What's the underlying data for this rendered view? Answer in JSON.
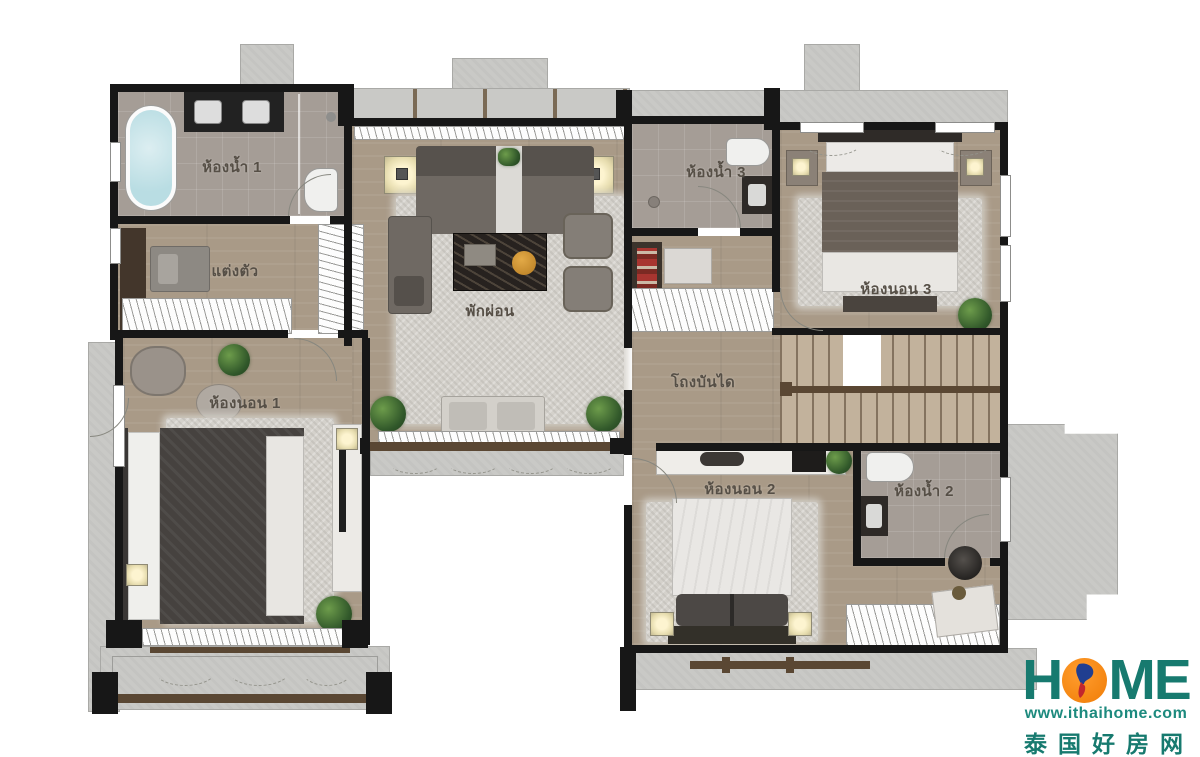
{
  "plan": {
    "rooms": {
      "bathroom1": "ห้องน้ำ 1",
      "dressing": "แต่งตัว",
      "bedroom1": "ห้องนอน 1",
      "living": "พักผ่อน",
      "bathroom3": "ห้องน้ำ 3",
      "bedroom3": "ห้องนอน 3",
      "stair_hall": "โถงบันได",
      "bedroom2": "ห้องนอน 2",
      "bathroom2": "ห้องน้ำ 2"
    }
  },
  "watermark": {
    "brand_h": "H",
    "brand_me": "ME",
    "url": "www.ithaihome.com",
    "cn": "泰国好房网",
    "palette": {
      "teal": "#177a6f",
      "orange": "#f6820d",
      "map_blue": "#203e90",
      "map_red": "#c2272d"
    }
  }
}
